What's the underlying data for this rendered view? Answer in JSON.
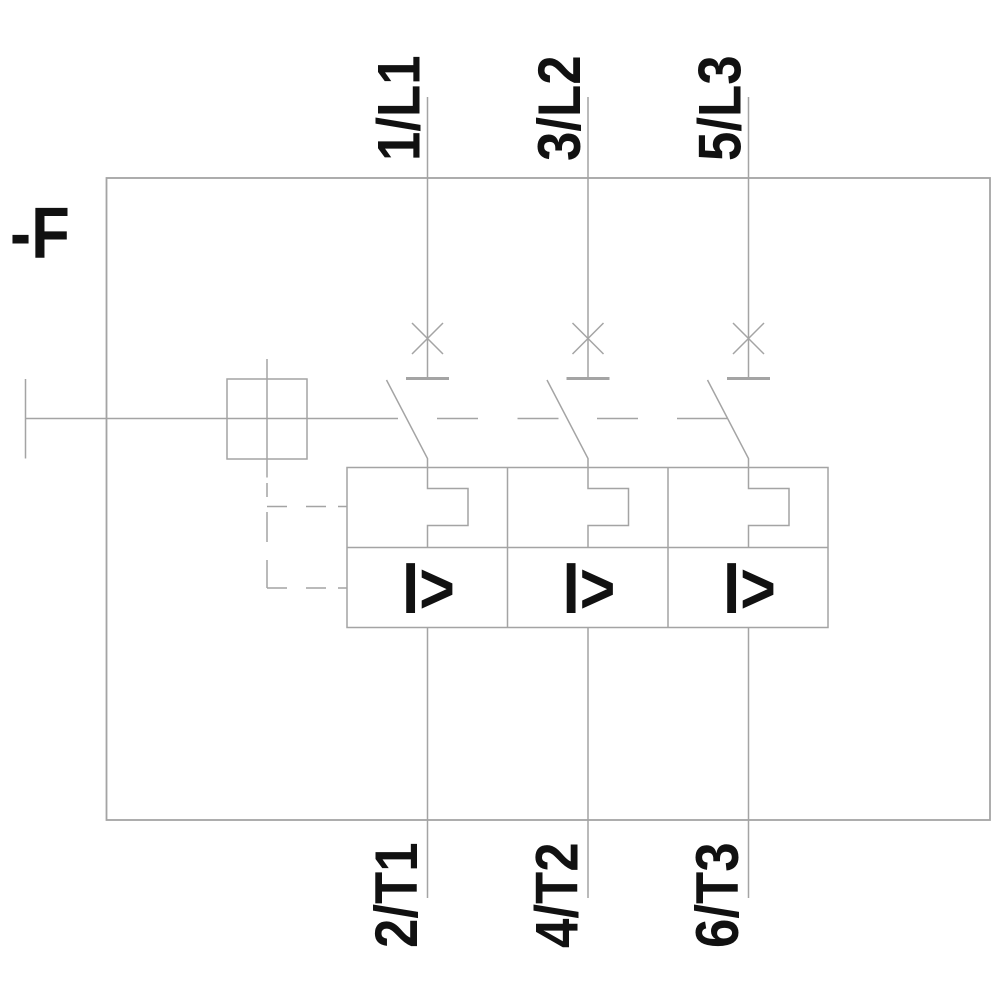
{
  "device_tag": "-F",
  "poles": [
    {
      "top_terminal": "1/L1",
      "bottom_terminal": "2/T1",
      "magnetic_trip_label": "I>"
    },
    {
      "top_terminal": "3/L2",
      "bottom_terminal": "4/T2",
      "magnetic_trip_label": "I>"
    },
    {
      "top_terminal": "5/L3",
      "bottom_terminal": "6/T3",
      "magnetic_trip_label": "I>"
    }
  ],
  "colors": {
    "line": "#a4a4a4",
    "text": "#111111",
    "background": "#ffffff"
  }
}
